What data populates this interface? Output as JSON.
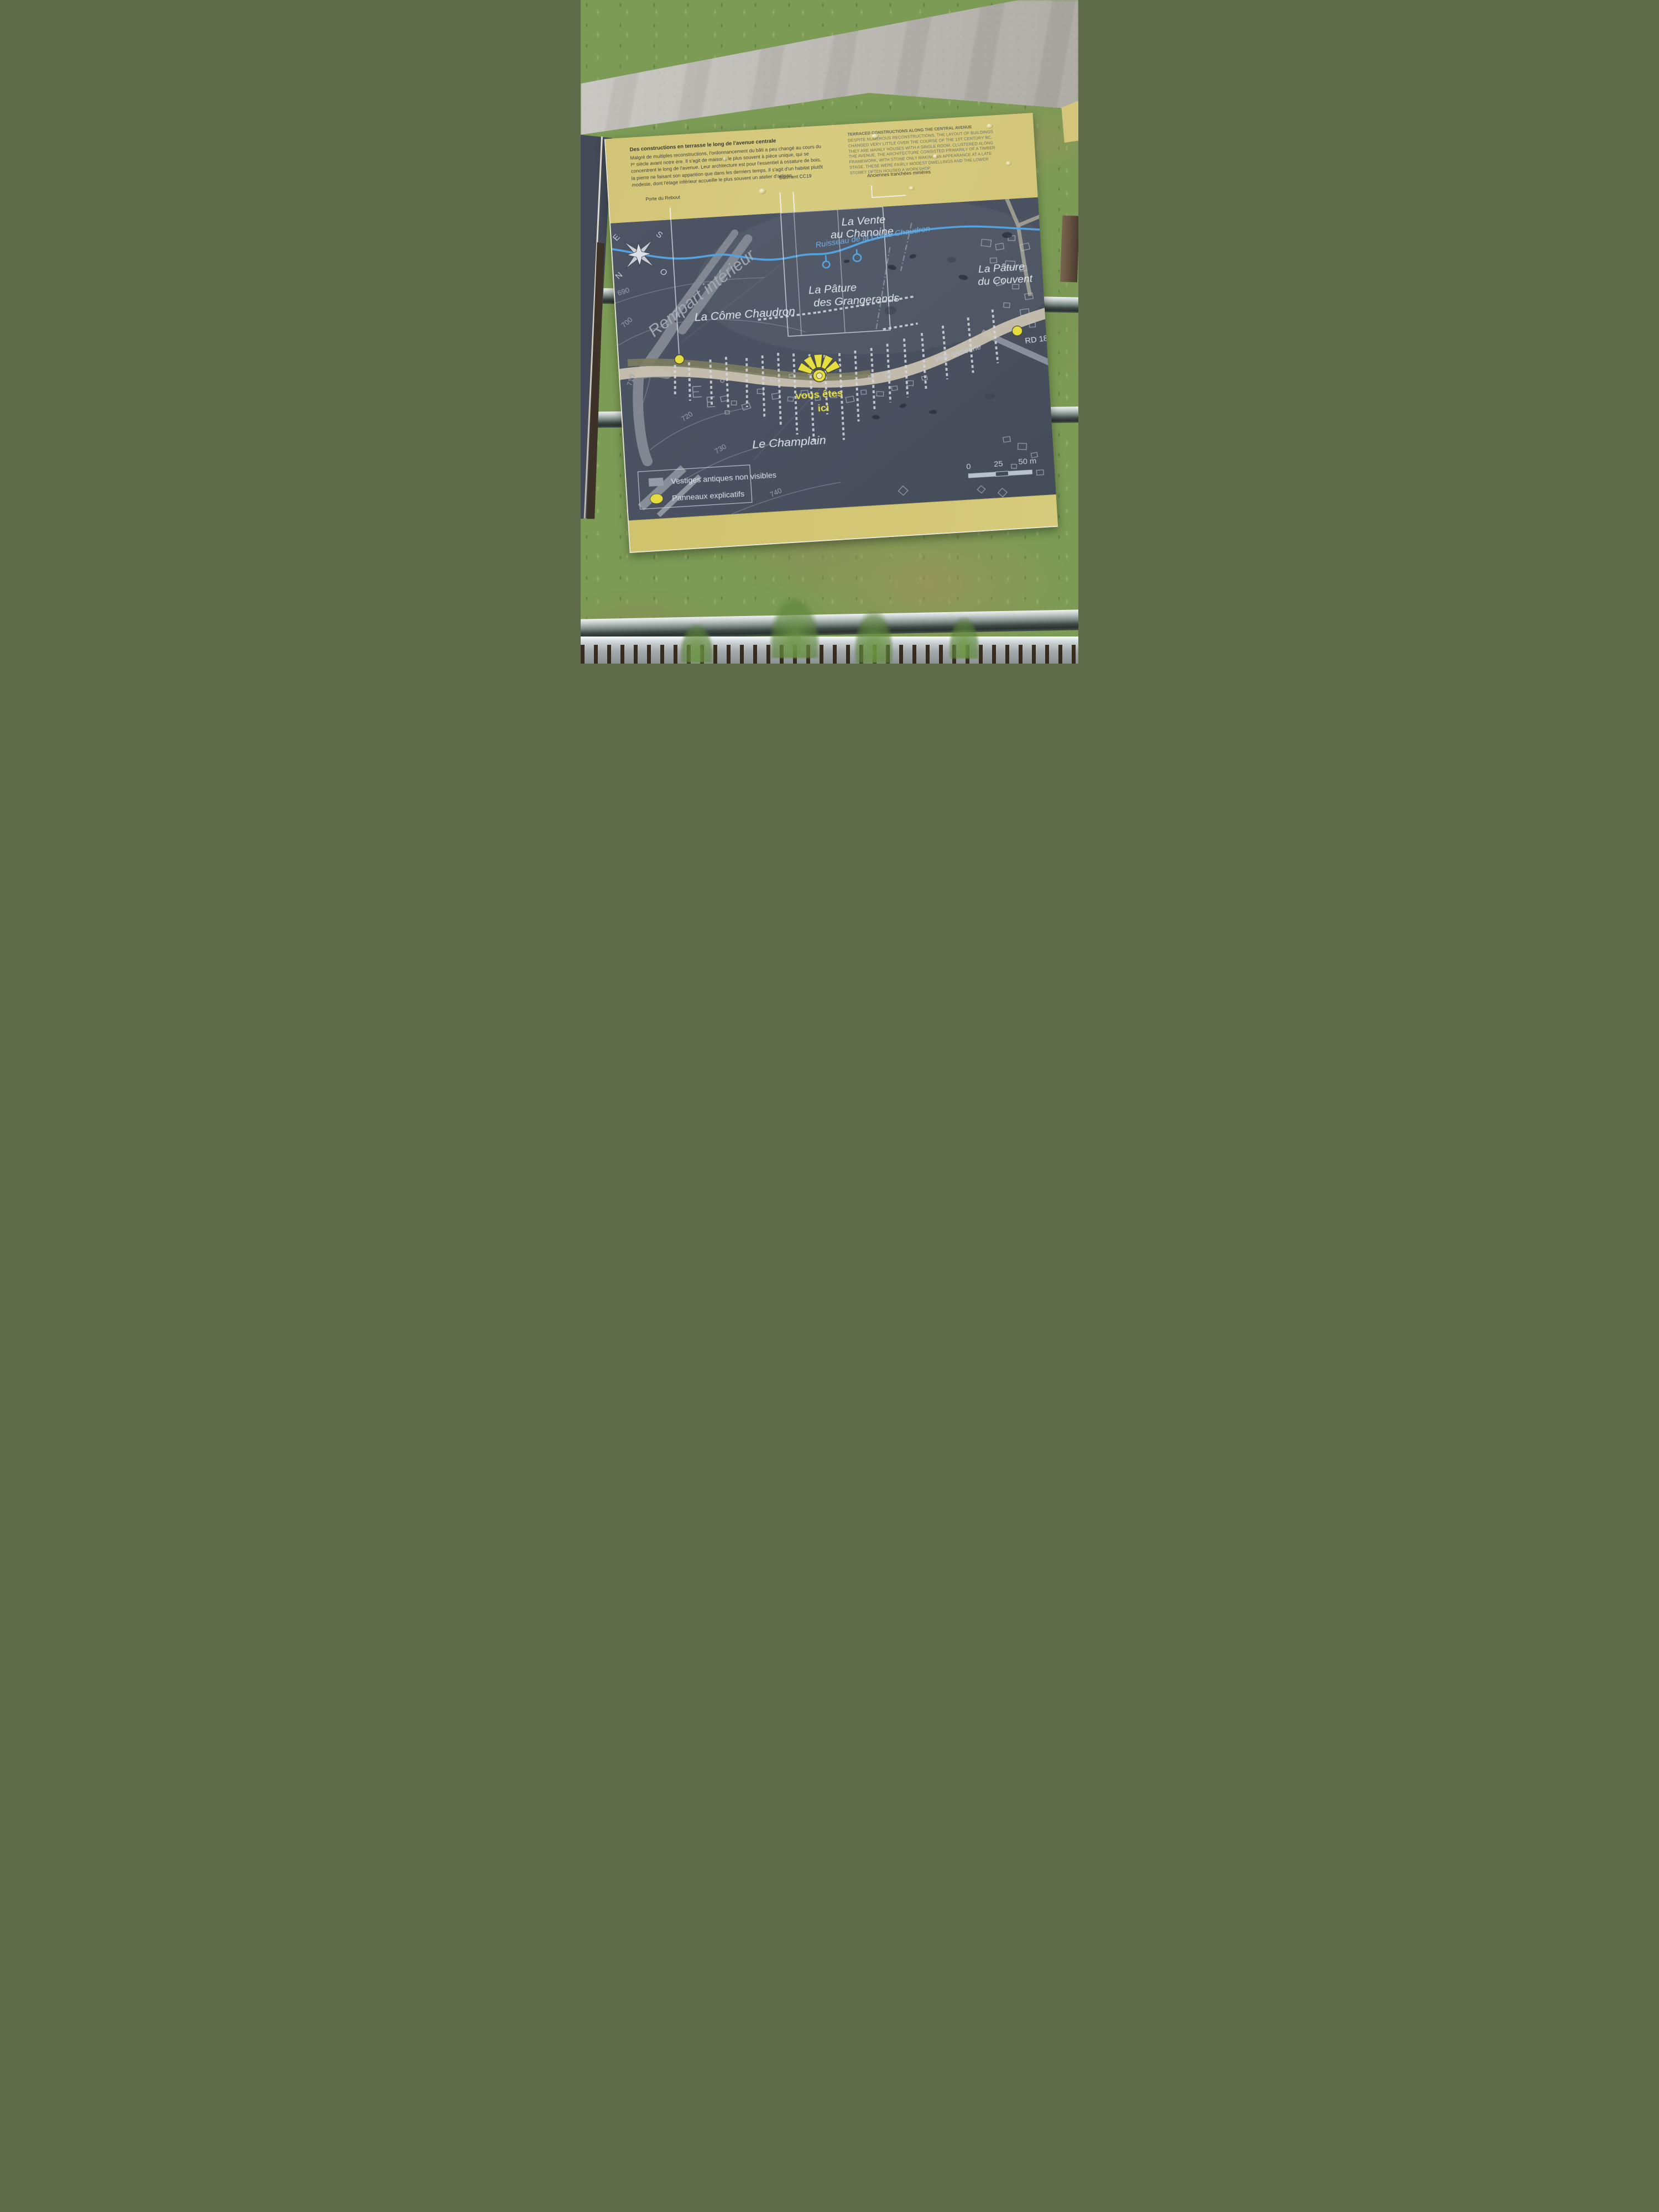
{
  "panel": {
    "title_fr": "Des constructions en terrasse le long de l'avenue centrale",
    "body_fr": "Malgré de multiples reconstructions, l'ordonnancement du bâti a peu changé au cours du Iᵉʳ siècle avant notre ère. Il s'agit de maisons le plus souvent à pièce unique, qui se concentrent le long de l'avenue. Leur architecture est pour l'essentiel à ossature de bois, la pierre ne faisant son apparition que dans les derniers temps. Il s'agit d'un habitat plutôt modeste, dont l'étage inférieur accueille le plus souvent un atelier d'artisan.",
    "title_en": "TERRACED CONSTRUCTIONS ALONG THE CENTRAL AVENUE",
    "body_en": "DESPITE NUMEROUS RECONSTRUCTIONS, THE LAYOUT OF BUILDINGS CHANGED VERY LITTLE OVER THE COURSE OF THE 1ST CENTURY BC. THEY ARE MAINLY HOUSES WITH A SINGLE ROOM, CLUSTERED ALONG THE AVENUE. THE ARCHITECTURE CONSISTED PRIMARILY OF A TIMBER FRAMEWORK, WITH STONE ONLY MAKING AN APPEARANCE AT A LATE STAGE. THESE WERE FAIRLY MODEST DWELLINGS AND THE LOWER STOREY OFTEN HOUSED A WORKSHOP.",
    "callouts": {
      "porte": "Porte du Rebout",
      "batiment": "Bâtiment CC19",
      "tranchees": "Anciennes tranchées minières"
    }
  },
  "map": {
    "compass": {
      "n": "N",
      "e": "E",
      "s": "S",
      "o": "O"
    },
    "labels": {
      "vente_1": "La Vente",
      "vente_2": "au Chanoine",
      "ruisseau": "Ruisseau de la Côme Chaudron",
      "pature_grangerands_1": "La Pâture",
      "pature_grangerands_2": "des Grangerands",
      "pature_couvent_1": "La Pâture",
      "pature_couvent_2": "du Couvent",
      "come_chaudron": "La Côme Chaudron",
      "rempart": "Rempart intérieur",
      "champlain": "Le Champlain",
      "voie_ancienne": "Voie ancienne",
      "rd18": "RD 18",
      "vous_etes_1": "vous êtes",
      "vous_etes_2": "ici"
    },
    "contours": [
      "690",
      "700",
      "710",
      "720",
      "730",
      "740"
    ],
    "legend": {
      "items": [
        {
          "label": "Vestiges antiques non visibles"
        },
        {
          "label": "Panneaux explicatifs"
        }
      ]
    },
    "scale": {
      "t0": "0",
      "t25": "25",
      "t50": "50 m"
    }
  },
  "colors": {
    "panel_yellow": "#d5c87a",
    "map_slate": "#4b5260",
    "accent_yellow": "#e3db3f",
    "stream_blue": "#55a2e0",
    "road_tan": "#c9c1b0",
    "label_white": "#e2e5ea"
  }
}
